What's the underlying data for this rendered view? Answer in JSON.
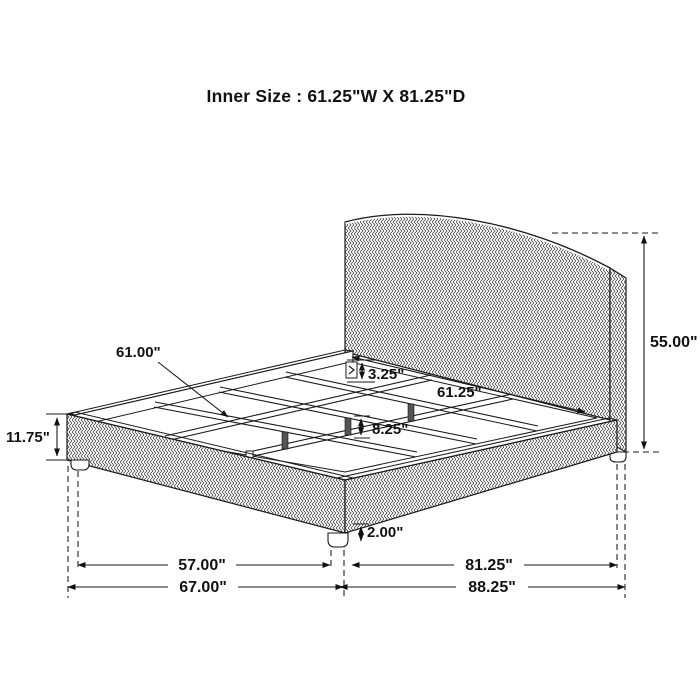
{
  "title": "Inner Size : 61.25\"W X 81.25\"D",
  "diagram_type": "bed-dimension-drawing",
  "colors": {
    "line": "#1a1a1a",
    "background": "#ffffff",
    "leg_fill": "#555555"
  },
  "dimensions": {
    "slat_length": "61.00\"",
    "rail_bracket_height": "3.25\"",
    "inner_width": "61.25\"",
    "headboard_height": "55.00\"",
    "footboard_height": "11.75\"",
    "center_leg_height": "8.25\"",
    "foot_height": "2.00\"",
    "width_between_legs": "57.00\"",
    "overall_width": "67.00\"",
    "depth_between_legs": "81.25\"",
    "overall_depth": "88.25\""
  }
}
